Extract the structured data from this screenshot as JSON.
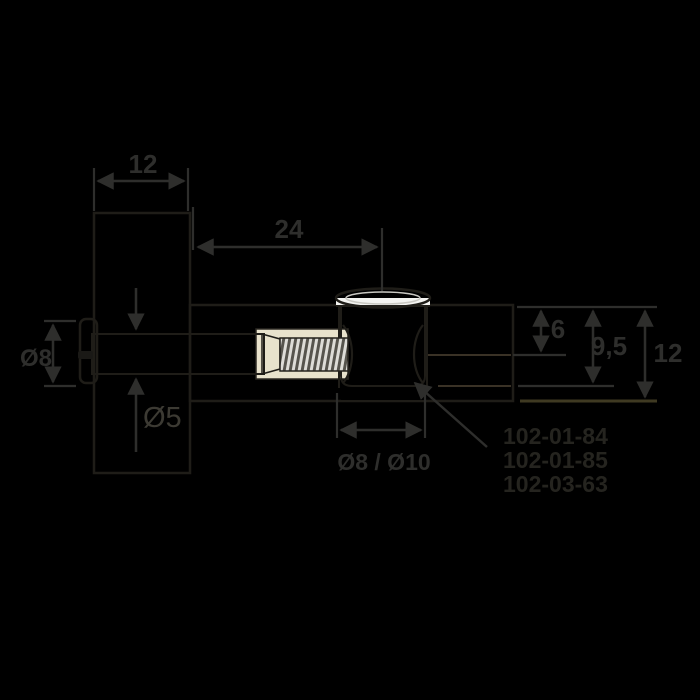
{
  "drawing": {
    "type": "technical-drawing",
    "subject": "furniture cam connector bolt joint, cross-section"
  },
  "colors": {
    "background": "#000000",
    "wood": "#b2a189",
    "wood_shadow": "#a08f75",
    "outline": "#1f1d18",
    "metal_light": "#f7f7f4",
    "metal_mid": "#d9d8d4",
    "metal_dark": "#8e8c85",
    "bore": "#e8e2cc",
    "dimension": "#2e2e2c",
    "panel_text": "#3c3a33",
    "part_number_text": "#25241f",
    "baseline_olive": "#3f3a22"
  },
  "dimensions": {
    "panel_width_top": "12",
    "bolt_length": "24",
    "head_diameter": "Ø8",
    "shaft_diameter": "Ø5",
    "cam_axis_depth": "6",
    "cam_hole_depth": "9,5",
    "shelf_thickness": "12",
    "cam_hole_diameter": "Ø8 / Ø10"
  },
  "part_numbers": [
    "102-01-84",
    "102-01-85",
    "102-03-63"
  ]
}
